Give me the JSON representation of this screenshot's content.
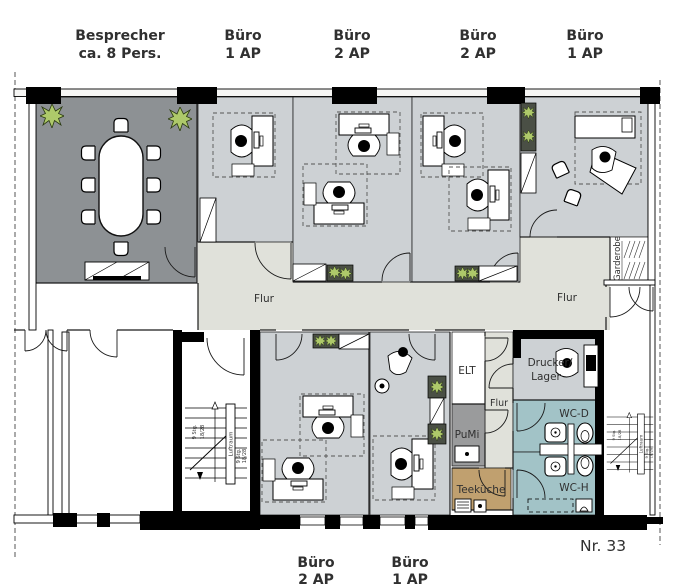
{
  "plan_number": "Nr. 33",
  "top_labels": [
    {
      "line1": "Besprecher",
      "line2": "ca. 8 Pers."
    },
    {
      "line1": "Büro",
      "line2": "1 AP"
    },
    {
      "line1": "Büro",
      "line2": "2 AP"
    },
    {
      "line1": "Büro",
      "line2": "2 AP"
    },
    {
      "line1": "Büro",
      "line2": "1 AP"
    }
  ],
  "bottom_labels": [
    {
      "line1": "Büro",
      "line2": "2 AP"
    },
    {
      "line1": "Büro",
      "line2": "1 AP"
    }
  ],
  "rooms": {
    "flur_left": "Flur",
    "flur_right": "Flur",
    "flur_small": "Flur",
    "elt": "ELT",
    "pumi": "PuMi",
    "teekueche": "Teeküche",
    "drucker_line1": "Drucker/",
    "drucker_line2": "Lager",
    "wc_d": "WC-D",
    "wc_h": "WC-H",
    "garderobe": "Garderobe"
  },
  "stairs": {
    "luftraum": "Luftraum",
    "count": "9 Stg.",
    "dimension": "18/28"
  },
  "colors": {
    "meeting_room": "#8d9194",
    "office": "#cdd1d4",
    "corridor": "#e0e1da",
    "wc": "#a2c3c7",
    "teekueche": "#c0a06f",
    "pumi": "#9a9b9c",
    "plant": "#aec96a",
    "wall": "#000000"
  }
}
